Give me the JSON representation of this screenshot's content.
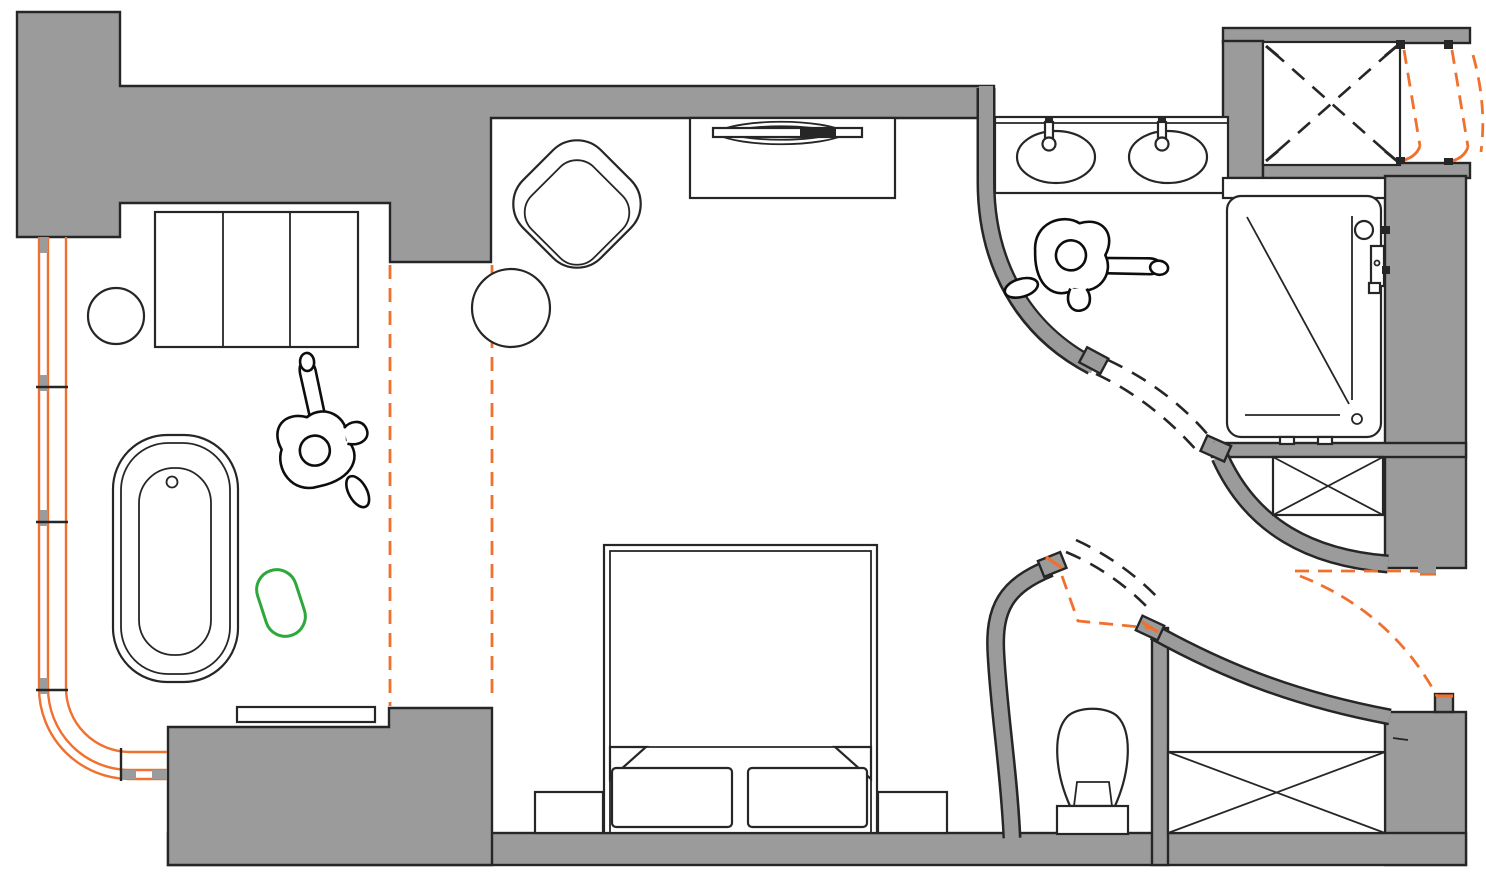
{
  "page": {
    "type": "architectural-floor-plan",
    "visible_text_present": false,
    "description_of_symbols_only": true
  },
  "colors": {
    "wall": "#9B9B9B",
    "line": "#262626",
    "floor": "#FFFFFF",
    "accent_orange": "#F0702E",
    "accent_green": "#2EA83C"
  },
  "plan": {
    "zones": [
      "bedroom",
      "bathtub-area",
      "vanity-area",
      "shower-area",
      "wc-area",
      "walk-in-closet"
    ],
    "fixtures": [
      "wardrobe-3-door",
      "round-stool",
      "freestanding-bathtub",
      "green-pouf-outline",
      "low-bench",
      "lounge-armchair",
      "round-side-table",
      "media-console",
      "tv-symbol",
      "double-bed",
      "pillow-left",
      "pillow-right",
      "nightstand-left",
      "nightstand-right",
      "vanity-counter",
      "sink-left",
      "sink-right",
      "faucet-left",
      "faucet-right",
      "shower-tray",
      "shower-mixer",
      "toilet",
      "crossed-cabinet-small",
      "crossed-closet-large",
      "shaft-void-crossed",
      "person-figure-bedroom",
      "person-figure-bathroom"
    ],
    "annotations": [
      "curtain-wall-glazing-orange",
      "glazing-mullions",
      "sliding-partition-dashed-orange",
      "door-swing-dashed-black",
      "door-leaf-dashed-orange",
      "door-hinge-blocks"
    ]
  }
}
